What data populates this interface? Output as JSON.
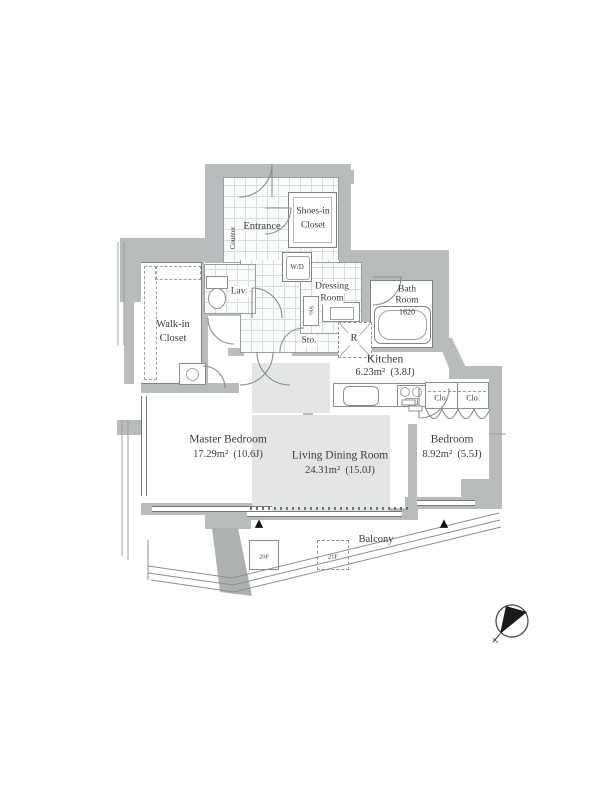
{
  "rooms": {
    "entrance": {
      "label": "Entrance"
    },
    "counter": {
      "label": "Counter"
    },
    "shoes_in_closet": {
      "line1": "Shoes-in",
      "line2": "Closet"
    },
    "wd": {
      "label": "W/D"
    },
    "dressing_room": {
      "line1": "Dressing",
      "line2": "Room"
    },
    "bath_room": {
      "line1": "Bath",
      "line2": "Room",
      "size": "1620"
    },
    "lav": {
      "label": "Lav."
    },
    "walk_in_closet": {
      "line1": "Walk-in",
      "line2": "Closet"
    },
    "storage_small": {
      "label": "Sto."
    },
    "storage": {
      "label": "Sto."
    },
    "refrigerator": {
      "label": "R"
    },
    "kitchen": {
      "name": "Kitchen",
      "area": "6.23m² (3.8J)"
    },
    "closet_left": {
      "label": "Clo."
    },
    "closet_right": {
      "label": "Clo."
    },
    "master_bedroom": {
      "name": "Master Bedroom",
      "area": "17.29m² (10.6J)"
    },
    "living_dining": {
      "name": "Living Dining Room",
      "area": "24.31m² (15.0J)"
    },
    "bedroom": {
      "name": "Bedroom",
      "area": "8.92m² (5.5J)"
    },
    "balcony": {
      "label": "Balcony"
    },
    "floor_box_1": {
      "label": "20F"
    },
    "floor_box_2": {
      "label": "21F"
    }
  },
  "misc": {
    "triangle": "▲"
  },
  "colors": {
    "wall": "#b9bcbd",
    "outline": "#7d8182",
    "rug": "#e4e6e5"
  }
}
